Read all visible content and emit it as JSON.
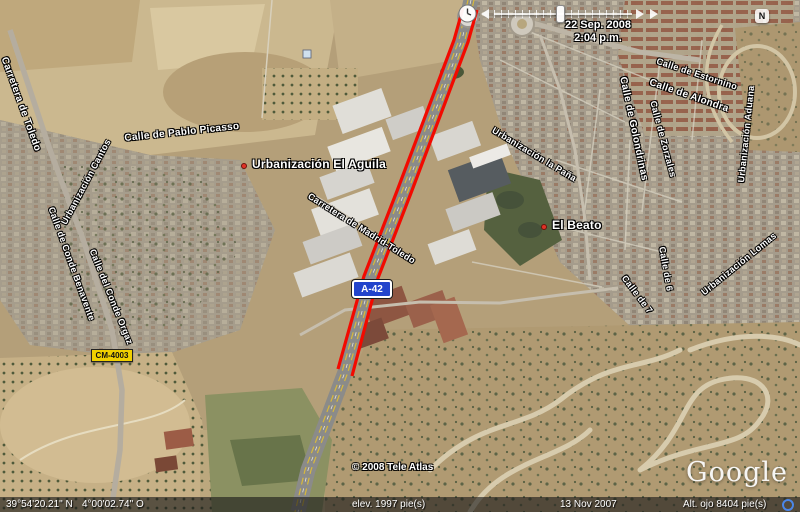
{
  "app": {
    "name": "Google Earth satellite view"
  },
  "compass": {
    "label": "N"
  },
  "time_slider": {
    "date_line1": "22 Sep. 2008",
    "date_line2": "2:04 p.m."
  },
  "road_shields": {
    "a42": {
      "label": "A-42",
      "color": "#2244cc"
    },
    "cm4003": {
      "label": "CM-4003",
      "color": "#f0d000"
    }
  },
  "map_labels": {
    "places": [
      {
        "label": "Urbanización El Aguila"
      },
      {
        "label": "El Beato"
      }
    ],
    "streets": [
      "Carretera de Toledo",
      "Calle de Pablo Picasso",
      "Urbanización Cantos",
      "Calle de Conde Benavente",
      "Calle del Conde Orgaz",
      "Carretera de Madrid-Toledo",
      "Urbanización la Paña",
      "Calle de Estornino",
      "Calle de Alondra",
      "Calle de Golondrinas",
      "Calle de Zorzales",
      "Urbanización Aduana",
      "Urbanización Lomas",
      "Calle de 6",
      "Calle de 7"
    ]
  },
  "watermarks": {
    "copyright": "© 2008 Tele Atlas",
    "logo": "Google"
  },
  "status_bar": {
    "latitude": "39°54'20.21\" N",
    "longitude": "4°00'02.74\" O",
    "elevation": "elev.  1997 pie(s)",
    "imagery_date": "13 Nov 2007",
    "eye_altitude": "Alt. ojo   8404 pie(s)"
  },
  "colors": {
    "route_red": "#f20a00",
    "shield_blue": "#2244cc",
    "shield_yellow": "#f0d000",
    "streaming_ring_blue": "#4b86e8"
  }
}
